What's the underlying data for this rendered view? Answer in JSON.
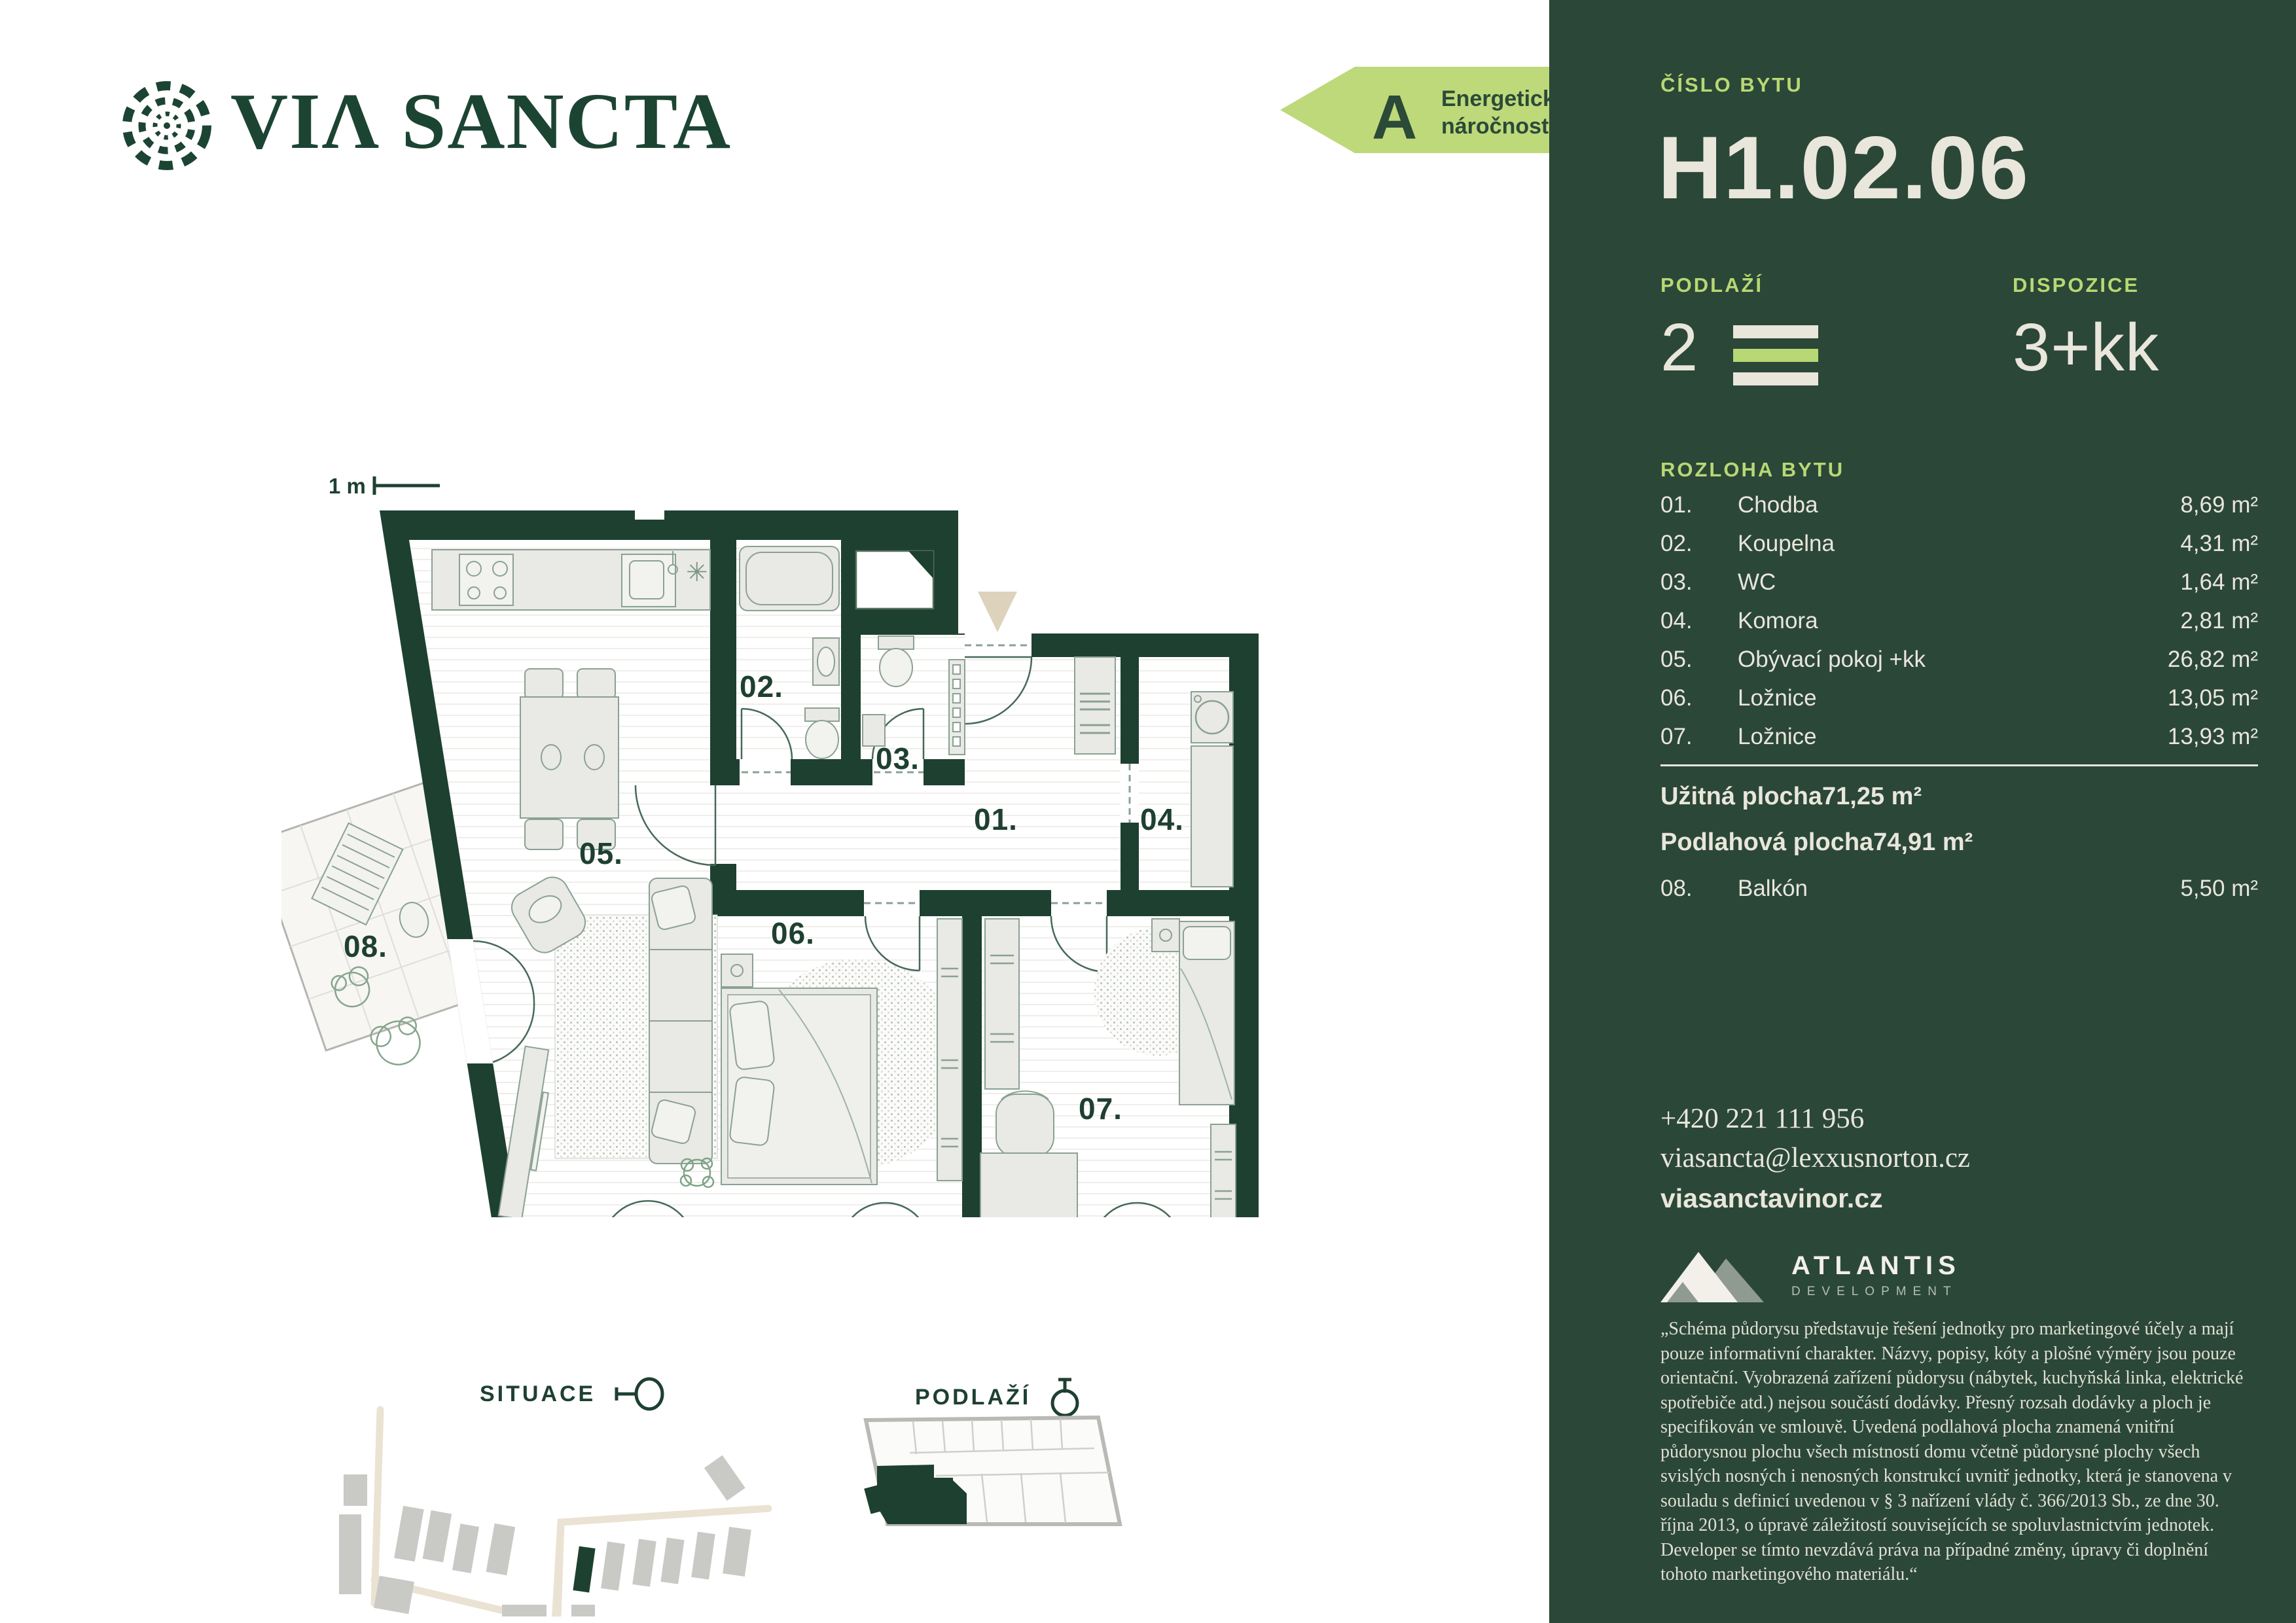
{
  "brand": {
    "logo_text": "VIΛ SANCTA"
  },
  "energy_label": {
    "grade": "A",
    "line1": "Energetická",
    "line2": "náročnost"
  },
  "unit": {
    "number_label": "ČÍSLO BYTU",
    "number": "H1.02.06",
    "floor_label": "PODLAŽÍ",
    "floor": "2",
    "layout_label": "DISPOZICE",
    "layout": "3+kk"
  },
  "rooms": {
    "heading": "ROZLOHA BYTU",
    "items": [
      {
        "no": "01.",
        "name": "Chodba",
        "area": "8,69 m²"
      },
      {
        "no": "02.",
        "name": "Koupelna",
        "area": "4,31 m²"
      },
      {
        "no": "03.",
        "name": "WC",
        "area": "1,64 m²"
      },
      {
        "no": "04.",
        "name": "Komora",
        "area": "2,81 m²"
      },
      {
        "no": "05.",
        "name": "Obývací pokoj +kk",
        "area": "26,82 m²"
      },
      {
        "no": "06.",
        "name": "Ložnice",
        "area": "13,05 m²"
      },
      {
        "no": "07.",
        "name": "Ložnice",
        "area": "13,93 m²"
      }
    ],
    "totals": [
      {
        "name": "Užitná plocha",
        "area": "71,25 m²"
      },
      {
        "name": "Podlahová plocha",
        "area": "74,91 m²"
      }
    ],
    "balcony": {
      "no": "08.",
      "name": "Balkón",
      "area": "5,50 m²"
    }
  },
  "contact": {
    "phone": "+420 221 111 956",
    "email": "viasancta@lexxusnorton.cz",
    "web": "viasanctavinor.cz"
  },
  "developer": {
    "name": "ATLANTIS",
    "subtitle": "DEVELOPMENT"
  },
  "disclaimer": "„Schéma půdorysu představuje řešení jednotky pro marketingové účely a mají pouze informativní charakter. Názvy, popisy, kóty a plošné výměry jsou pouze orientační. Vyobrazená zařízení půdorysu (nábytek, kuchyňská linka, elektrické spotřebiče atd.) nejsou součástí dodávky. Přesný rozsah dodávky a ploch je specifikován ve smlouvě. Uvedená podlahová plocha znamená vnitřní půdorysnou plochu všech místností domu včetně půdorysné plochy všech svislých nosných i nenosných konstrukcí uvnitř jednotky, která je stanovena v souladu s definicí uvedenou v § 3 nařízení vlády č. 366/2013 Sb., ze dne 30. října 2013, o úpravě záležitostí souvisejících se spoluvlastnictvím jednotek. Developer se tímto nevzdává práva na případné změny, úpravy či doplnění tohoto marketingového materiálu.“",
  "plan": {
    "scale_label": "1 m",
    "labels": {
      "r01": "01.",
      "r02": "02.",
      "r03": "03.",
      "r04": "04.",
      "r05": "05.",
      "r06": "06.",
      "r07": "07.",
      "r08": "08."
    }
  },
  "footer": {
    "situace": "SITUACE",
    "podlazi": "PODLAŽÍ"
  },
  "colors": {
    "panel_green": "#2b4737",
    "wall_green": "#1e4031",
    "light_green": "#b7d874",
    "cream": "#e9e6dc",
    "beige_triangle": "#ddd3bd"
  }
}
